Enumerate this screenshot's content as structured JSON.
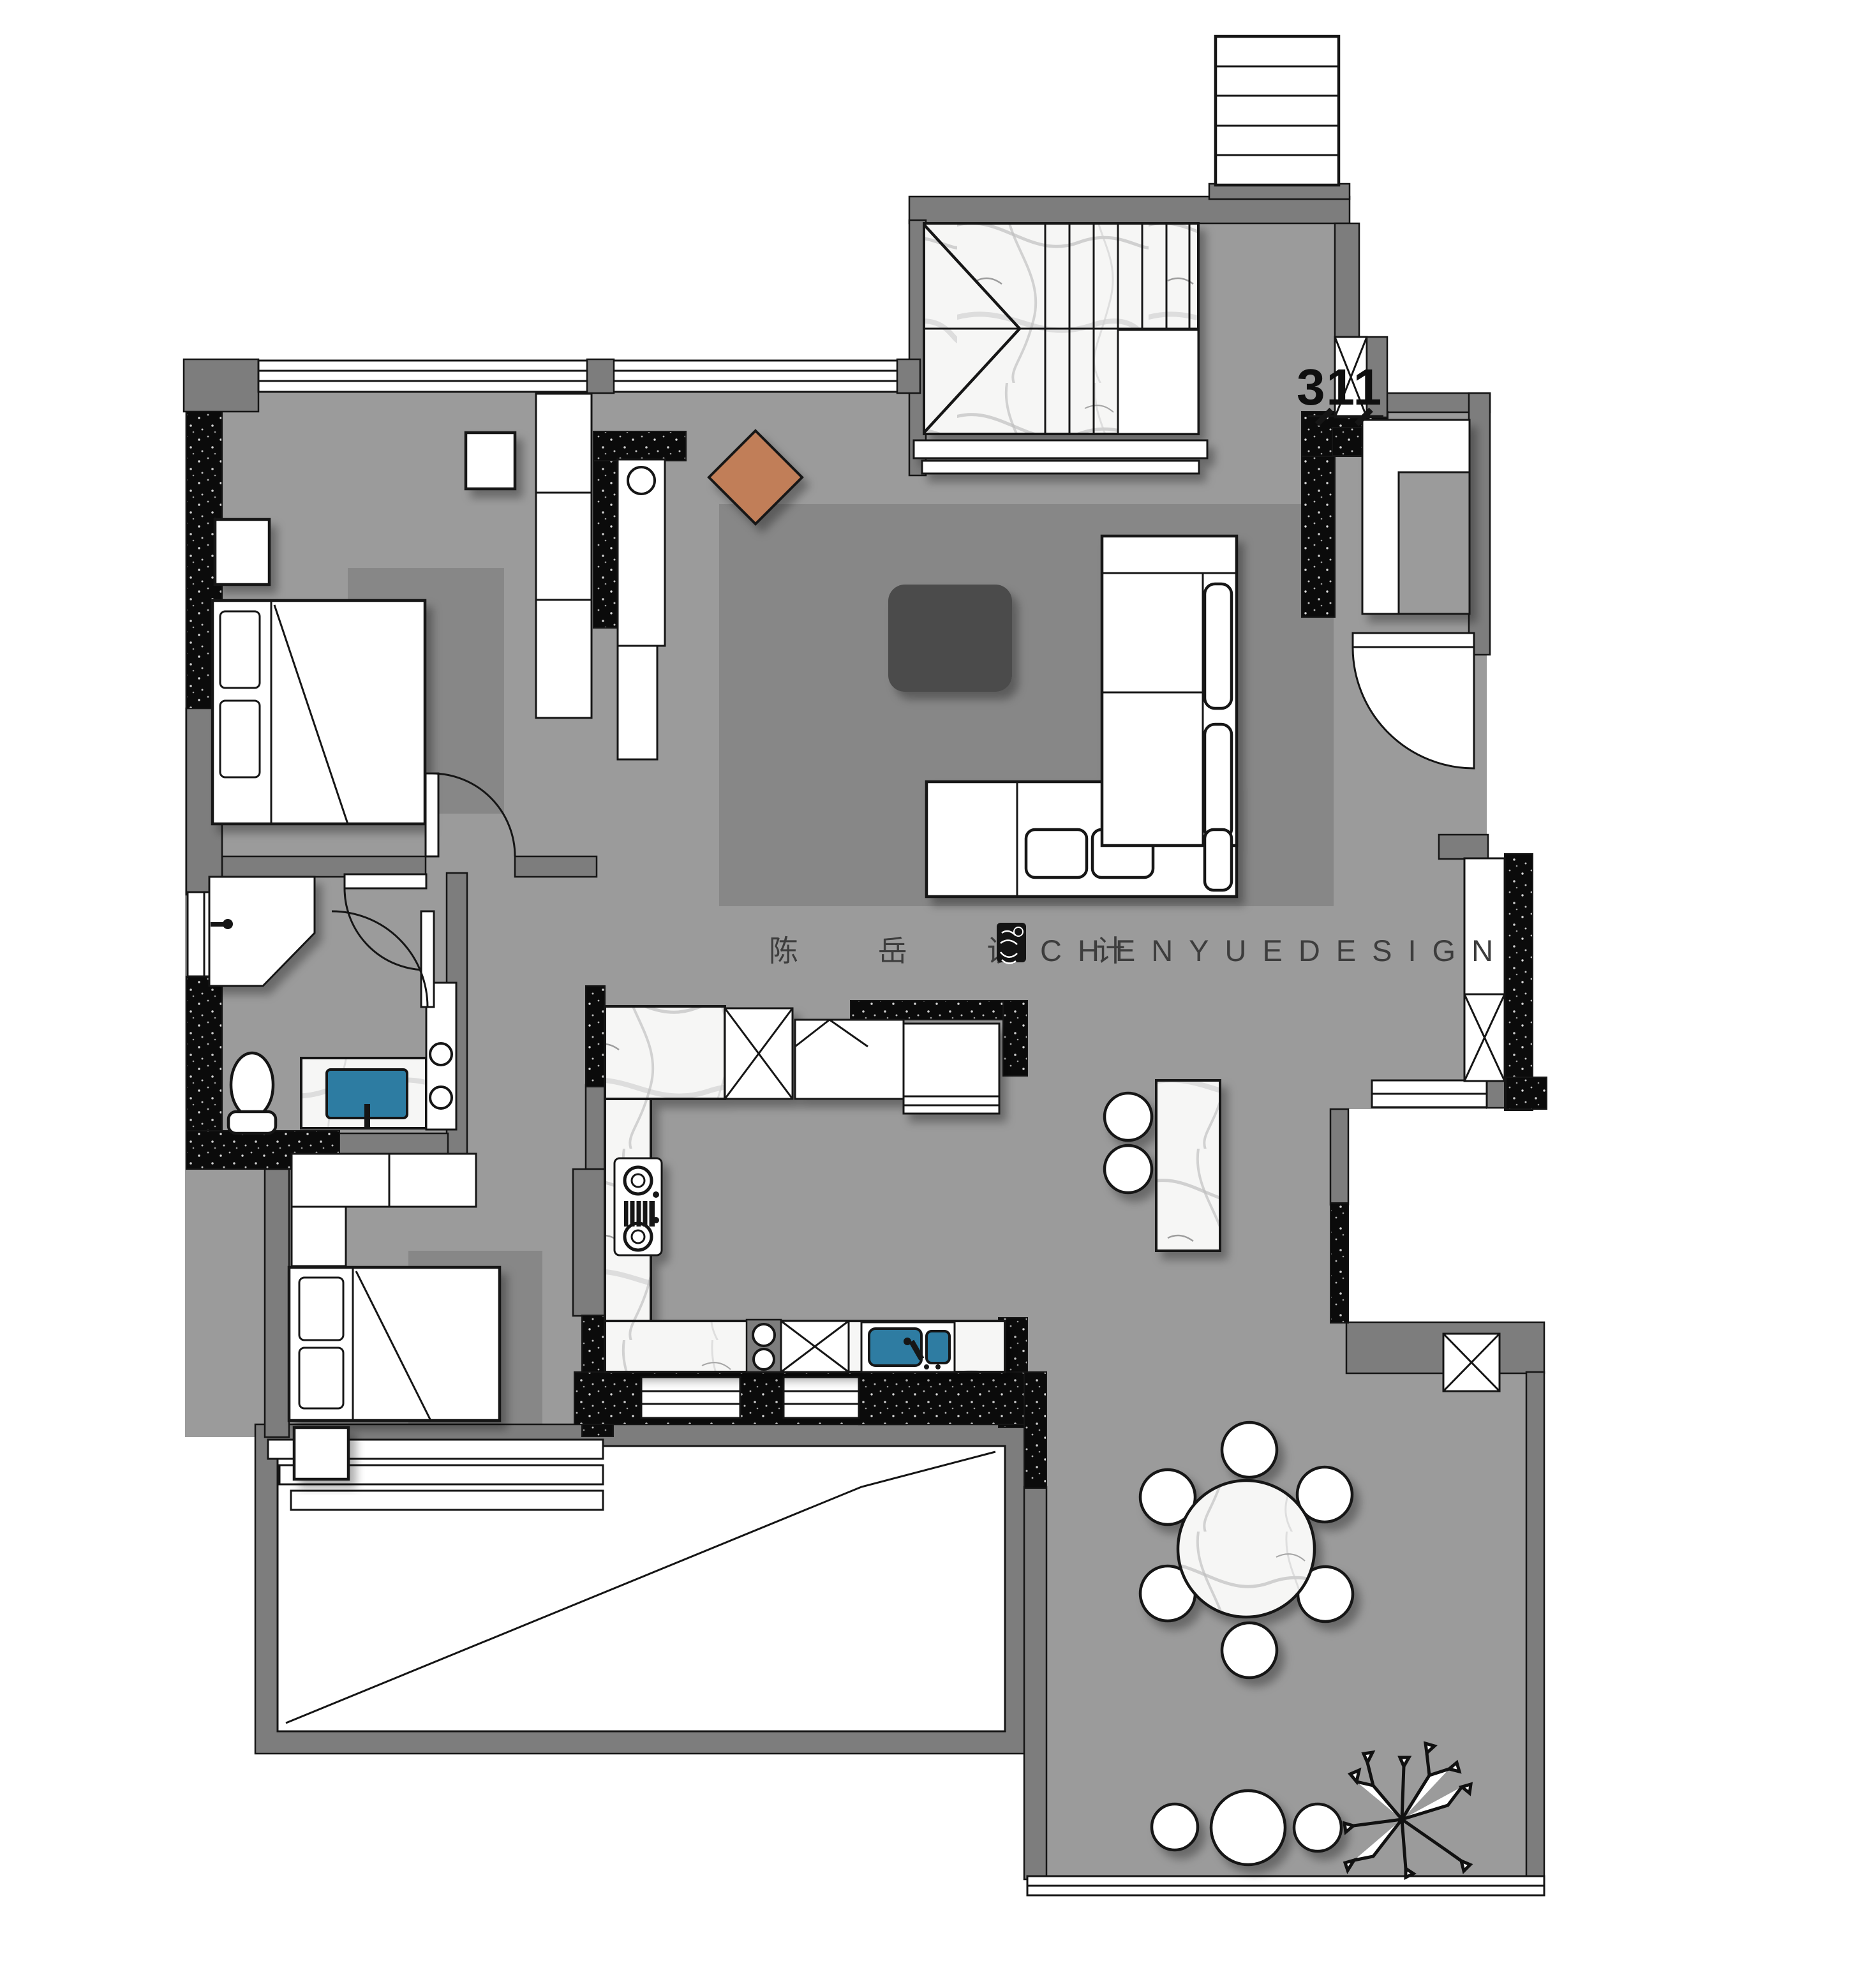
{
  "watermark": {
    "cn": "陈 岳 设 计",
    "en": "CHENYUEDESIGN"
  },
  "unit_label": "311",
  "colors": {
    "floor": "#9b9b9b",
    "rug": "#878787",
    "wall": "#7d7d7d",
    "wall_dark": "#0b0b0b",
    "line": "#151515",
    "marble": "#f6f6f5",
    "accent": "#c17e59",
    "sink": "#2d7ca2",
    "table": "#4b4b4b",
    "wm": "#3d3d3d"
  }
}
